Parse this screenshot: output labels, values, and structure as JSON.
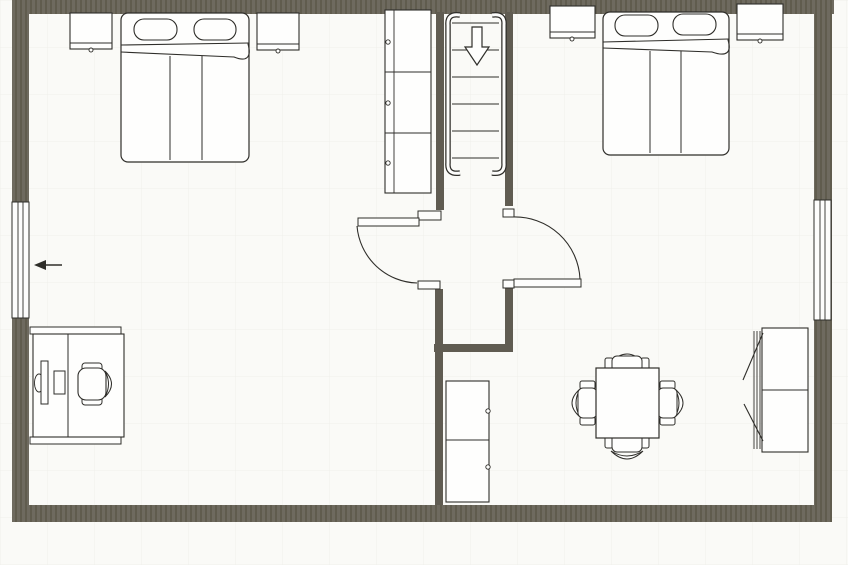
{
  "meta": {
    "description": "Scanned black-and-white architectural floor plan of an upper storey with two bedrooms, a central stair hall, two windows and an entry arrow"
  },
  "colors": {
    "canvas_bg": "#fafaf7",
    "grid_line": "#e8e7e2",
    "outer_wall": "#6e6a5f",
    "wall_hatch": "#595547",
    "inner_wall": "#605c52",
    "draw_line": "#2f2e2a",
    "furniture_fill": "#fefefd"
  },
  "plan": {
    "entry_arrow": {
      "icon": "left-arrow-icon",
      "direction": "left",
      "located_at": "left-window"
    },
    "stairs": {
      "direction_arrow": "down",
      "step_lines": 6,
      "handrails": 2
    },
    "windows": [
      {
        "wall": "left"
      },
      {
        "wall": "right"
      }
    ],
    "doors": [
      {
        "between": "stair-hall and left bedroom",
        "swing": "into-left-bedroom",
        "hinge": "top-jamb"
      },
      {
        "between": "stair-hall and right bedroom",
        "swing": "into-right-bedroom",
        "hinge": "bottom-jamb"
      }
    ],
    "left_bedroom": {
      "label": "left bedroom",
      "items": [
        "nightstand-left",
        "double-bed-with-two-pillows-and-folded-blanket",
        "nightstand-right",
        "desk-with-monitor-and-keyboard",
        "office-chair"
      ]
    },
    "stair_hall": {
      "label": "stair hall",
      "items": [
        "tall-cabinet-three-sections-three-knobs",
        "staircase-with-down-arrow",
        "low-cabinet-two-sections-two-knobs"
      ]
    },
    "right_bedroom": {
      "label": "right bedroom",
      "items": [
        "nightstand-left",
        "double-bed-with-two-pillows-and-folded-blanket",
        "nightstand-right",
        "square-dining-table-with-four-chairs",
        "two-section-wardrobe-open-doors"
      ]
    }
  }
}
